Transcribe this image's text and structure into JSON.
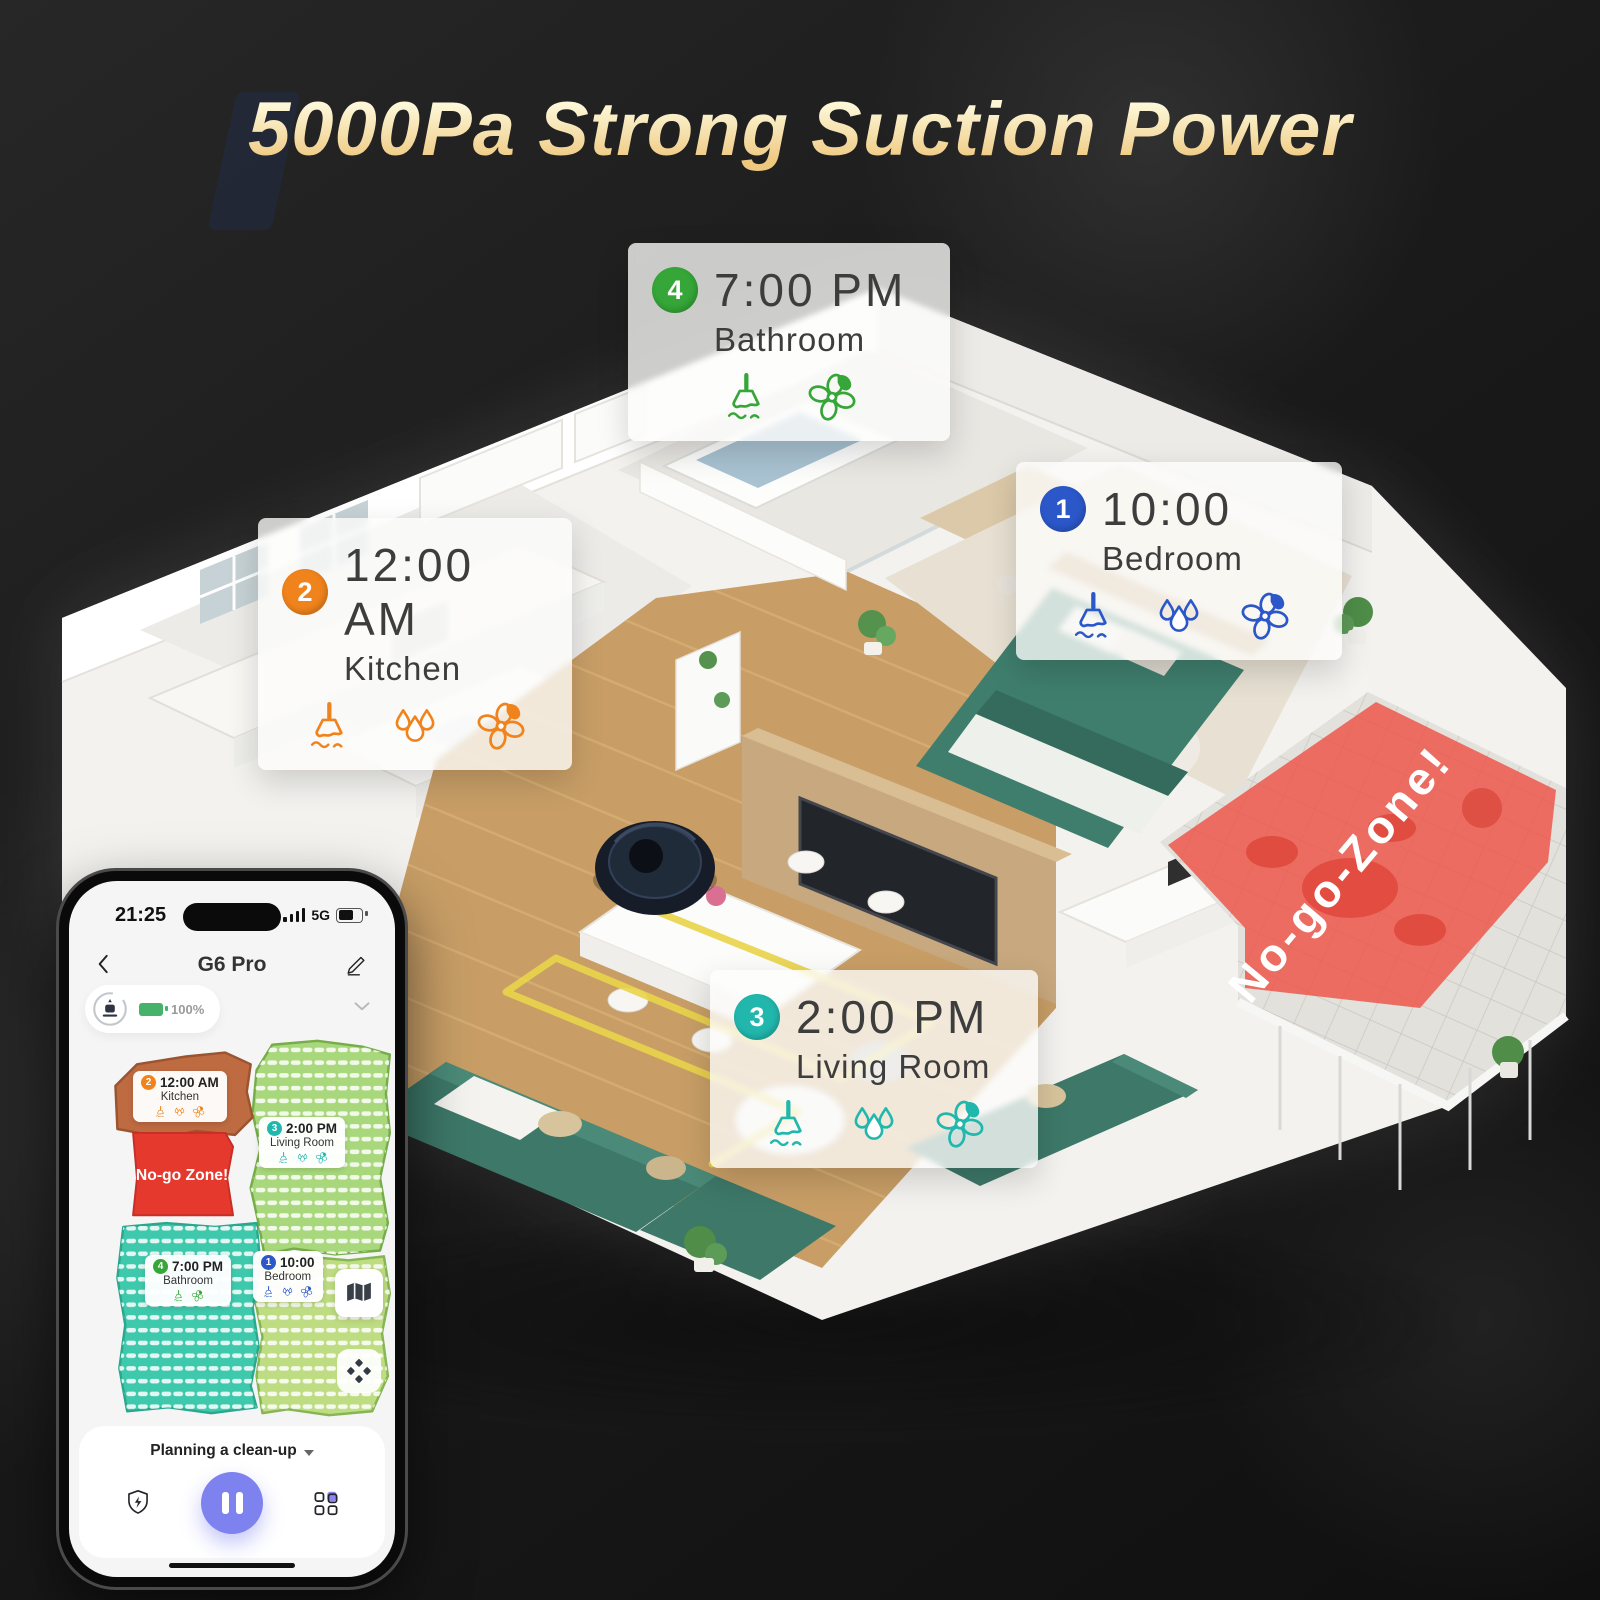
{
  "title": "5000Pa Strong Suction Power",
  "rooms": [
    {
      "order": "1",
      "time": "10:00",
      "name": "Bedroom",
      "color": "#2b57c9",
      "tasks": [
        "vacuum",
        "mop",
        "dry"
      ]
    },
    {
      "order": "2",
      "time": "12:00 AM",
      "name": "Kitchen",
      "color": "#f0831c",
      "tasks": [
        "vacuum",
        "mop",
        "dry"
      ]
    },
    {
      "order": "3",
      "time": "2:00 PM",
      "name": "Living Room",
      "color": "#21b7ad",
      "tasks": [
        "vacuum",
        "mop",
        "dry"
      ]
    },
    {
      "order": "4",
      "time": "7:00 PM",
      "name": "Bathroom",
      "color": "#35a637",
      "tasks": [
        "vacuum",
        "dry"
      ]
    }
  ],
  "no_go": {
    "house_label": "No-go-Zone!",
    "map_label": "No-go Zone!",
    "color": "#e8493c"
  },
  "icon_legend": {
    "vacuum": "broom-icon",
    "mop": "water-drops-icon",
    "dry": "fan-icon"
  },
  "phone": {
    "status_bar": {
      "time": "21:25",
      "network": "5G"
    },
    "nav": {
      "title": "G6 Pro"
    },
    "battery": {
      "percent": "100%"
    },
    "footer": {
      "mode_label": "Planning a clean-up"
    },
    "accent_purple": "#7d82ef",
    "map_zone_colors": {
      "kitchen": "#bf6b41",
      "living_room": "#a8d87b",
      "bedroom": "#bedc82",
      "bathroom": "#3ec9ac",
      "no_go": "#e6392e"
    }
  }
}
